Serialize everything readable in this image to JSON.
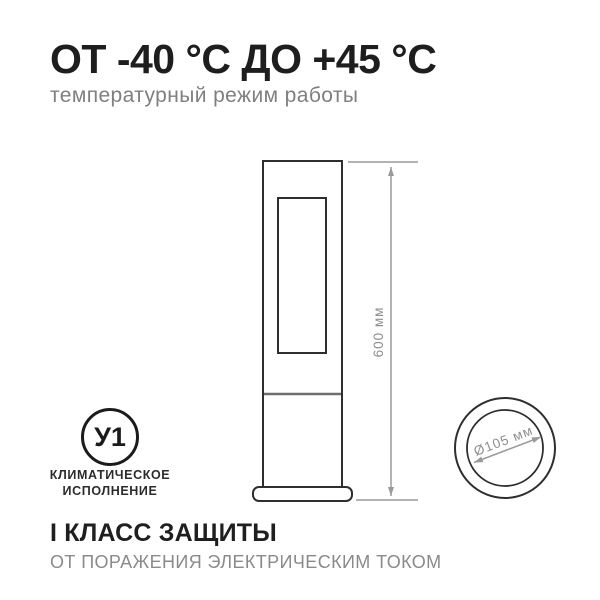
{
  "header": {
    "title": "ОТ -40 °C ДО +45 °C",
    "subtitle": "температурный режим работы"
  },
  "diagram": {
    "height_label": "600 мм",
    "diameter_label": "Ø105 мм"
  },
  "climate_badge": {
    "code": "У1",
    "caption_line1": "КЛИМАТИЧЕСКОЕ",
    "caption_line2": "ИСПОЛНЕНИЕ"
  },
  "footer": {
    "title": "I КЛАСС ЗАЩИТЫ",
    "subtitle": "ОТ ПОРАЖЕНИЯ ЭЛЕКТРИЧЕСКИМ ТОКОМ"
  },
  "colors": {
    "text_dark": "#1e1e1e",
    "text_gray": "#7f7f7f",
    "caption_dark": "#2c2c2c",
    "fixture_line": "#2e2e2e",
    "fixture_divider": "#6e6e6e",
    "dimension_line": "#9a9a9a",
    "dimension_text": "#8f8f8f",
    "background": "#ffffff"
  }
}
